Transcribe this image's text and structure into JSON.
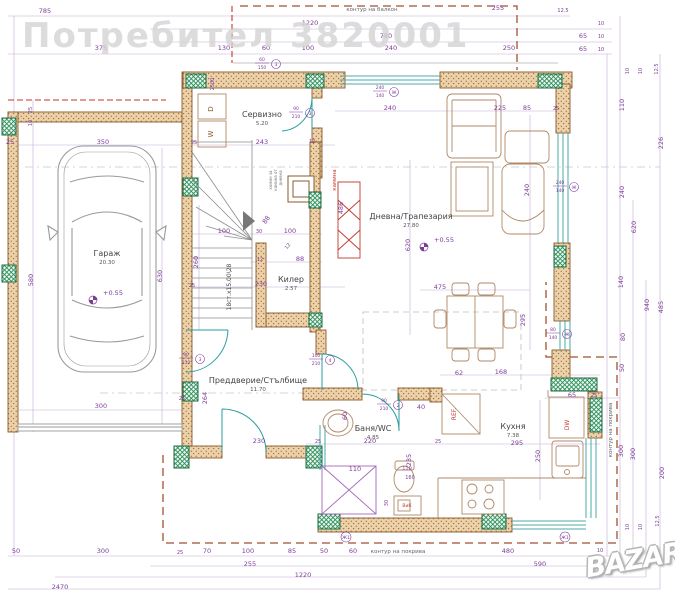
{
  "watermarks": {
    "top": "Потребител 3820001",
    "logo": "BAZAR"
  },
  "plan": {
    "colors": {
      "dimension": "#7d3c98",
      "wall": "#c98d52",
      "column": "#2f8f5b",
      "door": "#2a9d9d",
      "red": "#c0392b",
      "roof": "#a0522d",
      "furniture": "#b08968"
    },
    "rooms": [
      {
        "name": "Гараж",
        "area": "20.30",
        "x": 107,
        "y": 256
      },
      {
        "name": "Сервизно",
        "area": "5.20",
        "x": 262,
        "y": 117
      },
      {
        "name": "Дневна/Трапезария",
        "area": "27.80",
        "x": 411,
        "y": 219
      },
      {
        "name": "Килер",
        "area": "2.57",
        "x": 291,
        "y": 282
      },
      {
        "name": "Преддверие/Стълбище",
        "area": "11.70",
        "x": 258,
        "y": 383
      },
      {
        "name": "Баня/WC",
        "area": "4.85",
        "x": 373,
        "y": 431
      },
      {
        "name": "Кухня",
        "area": "7.38",
        "x": 513,
        "y": 429
      }
    ],
    "annotations": [
      {
        "t": "контур на балкон",
        "x": 372,
        "y": 11,
        "s": 5.5,
        "c": "#666"
      },
      {
        "t": "контур на покрива",
        "x": 398,
        "y": 553,
        "s": 5.5,
        "c": "#666"
      },
      {
        "t": "контур на покрива",
        "x": 612,
        "y": 430,
        "s": 5.5,
        "c": "#666",
        "r": -90
      },
      {
        "t": "D",
        "x": 213,
        "y": 109,
        "s": 7,
        "c": "#8a5a2b",
        "r": -90
      },
      {
        "t": "W",
        "x": 213,
        "y": 134,
        "s": 7,
        "c": "#8a5a2b",
        "r": -90
      },
      {
        "t": "REF.",
        "x": 456,
        "y": 414,
        "s": 6,
        "c": "#c0392b",
        "r": -90
      },
      {
        "t": "DW",
        "x": 569,
        "y": 425,
        "s": 6,
        "c": "#c0392b",
        "r": -90
      },
      {
        "t": "ВиК",
        "x": 407,
        "y": 507,
        "s": 4.5,
        "c": "#c0392b"
      },
      {
        "t": "камина",
        "x": 336,
        "y": 180,
        "s": 5.5,
        "c": "#c0392b",
        "r": -90
      },
      {
        "t": "комин за",
        "x": 272,
        "y": 180,
        "s": 4,
        "c": "#777",
        "r": -90
      },
      {
        "t": "камина от",
        "x": 277,
        "y": 180,
        "s": 4,
        "c": "#777",
        "r": -90
      },
      {
        "t": "дневна",
        "x": 282,
        "y": 178,
        "s": 4,
        "c": "#777",
        "r": -90
      },
      {
        "t": "18ст.х15.00\\28",
        "x": 231,
        "y": 287,
        "s": 6,
        "c": "#444",
        "r": -90
      }
    ],
    "levels": [
      {
        "label": "+0.55",
        "x": 93,
        "y": 300
      },
      {
        "label": "+0.55",
        "x": 424,
        "y": 247
      }
    ],
    "tags": [
      {
        "w": "90",
        "h": "210",
        "n": "3",
        "x": 296,
        "y": 112
      },
      {
        "w": "60",
        "h": "150",
        "n": "3",
        "x": 262,
        "y": 63
      },
      {
        "w": "240",
        "h": "140",
        "n": "Ж",
        "x": 380,
        "y": 91
      },
      {
        "w": "240",
        "h": "140",
        "n": "Ж",
        "x": 560,
        "y": 186
      },
      {
        "w": "80",
        "h": "140",
        "n": "Ж",
        "x": 553,
        "y": 333
      },
      {
        "w": "90",
        "h": "210",
        "n": "3",
        "x": 186,
        "y": 358
      },
      {
        "w": "100",
        "h": "210",
        "n": "4",
        "x": 316,
        "y": 359
      },
      {
        "w": "90",
        "h": "210",
        "n": "2",
        "x": 384,
        "y": 404
      },
      {
        "w": "",
        "h": "",
        "n": "Ж1",
        "x": 346,
        "y": 537
      },
      {
        "w": "",
        "h": "",
        "n": "Ж1",
        "x": 565,
        "y": 537
      }
    ],
    "dimensions": [
      {
        "t": "785",
        "x": 45,
        "y": 13
      },
      {
        "t": "255",
        "x": 498,
        "y": 10
      },
      {
        "t": "12.5",
        "x": 563,
        "y": 12,
        "s": 5
      },
      {
        "t": "1220",
        "x": 310,
        "y": 25
      },
      {
        "t": "780",
        "x": 386,
        "y": 38
      },
      {
        "t": "375",
        "x": 101,
        "y": 50
      },
      {
        "t": "130",
        "x": 224,
        "y": 50
      },
      {
        "t": "60",
        "x": 266,
        "y": 50
      },
      {
        "t": "100",
        "x": 308,
        "y": 50
      },
      {
        "t": "240",
        "x": 391,
        "y": 50
      },
      {
        "t": "250",
        "x": 509,
        "y": 50
      },
      {
        "t": "65",
        "x": 583,
        "y": 38
      },
      {
        "t": "10",
        "x": 601,
        "y": 25,
        "s": 5
      },
      {
        "t": "65",
        "x": 583,
        "y": 51
      },
      {
        "t": "10",
        "x": 601,
        "y": 38,
        "s": 5
      },
      {
        "t": "10",
        "x": 601,
        "y": 51,
        "s": 5
      },
      {
        "t": "10",
        "x": 629,
        "y": 71,
        "r": -90,
        "s": 5
      },
      {
        "t": "10",
        "x": 642,
        "y": 71,
        "r": -90,
        "s": 5
      },
      {
        "t": "12.5",
        "x": 658,
        "y": 69,
        "r": -90,
        "s": 5
      },
      {
        "t": "110",
        "x": 624,
        "y": 105,
        "r": -90
      },
      {
        "t": "226",
        "x": 663,
        "y": 143,
        "r": -90
      },
      {
        "t": "240",
        "x": 624,
        "y": 192,
        "r": -90
      },
      {
        "t": "620",
        "x": 636,
        "y": 227,
        "r": -90
      },
      {
        "t": "140",
        "x": 623,
        "y": 282,
        "r": -90
      },
      {
        "t": "940",
        "x": 649,
        "y": 305,
        "r": -90
      },
      {
        "t": "485",
        "x": 663,
        "y": 307,
        "r": -90
      },
      {
        "t": "80",
        "x": 625,
        "y": 337,
        "r": -90
      },
      {
        "t": "50",
        "x": 624,
        "y": 368,
        "r": -90
      },
      {
        "t": "300",
        "x": 623,
        "y": 451,
        "r": -90
      },
      {
        "t": "300",
        "x": 635,
        "y": 454,
        "r": -90
      },
      {
        "t": "200",
        "x": 664,
        "y": 473,
        "r": -90
      },
      {
        "t": "10",
        "x": 629,
        "y": 527,
        "r": -90,
        "s": 5
      },
      {
        "t": "10",
        "x": 642,
        "y": 527,
        "r": -90,
        "s": 5
      },
      {
        "t": "12.5",
        "x": 659,
        "y": 521,
        "r": -90,
        "s": 5
      },
      {
        "t": "25",
        "x": 10,
        "y": 144
      },
      {
        "t": "25",
        "x": 32,
        "y": 110,
        "r": -90,
        "s": 5
      },
      {
        "t": "10",
        "x": 32,
        "y": 123,
        "r": -90,
        "s": 5
      },
      {
        "t": "580",
        "x": 33,
        "y": 280,
        "r": -90
      },
      {
        "t": "630",
        "x": 162,
        "y": 276,
        "r": -90
      },
      {
        "t": "350",
        "x": 103,
        "y": 144
      },
      {
        "t": "25",
        "x": 194,
        "y": 144,
        "s": 5
      },
      {
        "t": "243",
        "x": 262,
        "y": 144
      },
      {
        "t": "12",
        "x": 312,
        "y": 143,
        "s": 5
      },
      {
        "t": "2500",
        "x": 214,
        "y": 84,
        "r": -90,
        "s": 5
      },
      {
        "t": "300",
        "x": 101,
        "y": 408
      },
      {
        "t": "100",
        "x": 224,
        "y": 233
      },
      {
        "t": "30",
        "x": 259,
        "y": 233,
        "s": 5
      },
      {
        "t": "100",
        "x": 290,
        "y": 233
      },
      {
        "t": "88",
        "x": 268,
        "y": 221,
        "r": -55
      },
      {
        "t": "12",
        "x": 289,
        "y": 247,
        "r": -55,
        "s": 5
      },
      {
        "t": "12",
        "x": 260,
        "y": 261,
        "s": 5
      },
      {
        "t": "88",
        "x": 300,
        "y": 261
      },
      {
        "t": "260",
        "x": 198,
        "y": 262,
        "r": -90
      },
      {
        "t": "230",
        "x": 261,
        "y": 286
      },
      {
        "t": "25",
        "x": 192,
        "y": 287,
        "s": 5
      },
      {
        "t": "486",
        "x": 343,
        "y": 208,
        "r": -90
      },
      {
        "t": "240",
        "x": 390,
        "y": 110
      },
      {
        "t": "225",
        "x": 500,
        "y": 110
      },
      {
        "t": "85",
        "x": 527,
        "y": 110
      },
      {
        "t": "25",
        "x": 556,
        "y": 110,
        "s": 5
      },
      {
        "t": "620",
        "x": 410,
        "y": 245,
        "r": -90
      },
      {
        "t": "240",
        "x": 529,
        "y": 190,
        "r": -90
      },
      {
        "t": "475",
        "x": 440,
        "y": 289
      },
      {
        "t": "295",
        "x": 525,
        "y": 320,
        "r": -90
      },
      {
        "t": "264",
        "x": 207,
        "y": 398,
        "r": -90
      },
      {
        "t": "230",
        "x": 259,
        "y": 443
      },
      {
        "t": "25",
        "x": 182,
        "y": 400,
        "s": 5
      },
      {
        "t": "60",
        "x": 347,
        "y": 416,
        "r": -90
      },
      {
        "t": "110",
        "x": 355,
        "y": 471
      },
      {
        "t": "220",
        "x": 370,
        "y": 443
      },
      {
        "t": "25",
        "x": 318,
        "y": 443,
        "s": 5
      },
      {
        "t": "25",
        "x": 438,
        "y": 443,
        "s": 5
      },
      {
        "t": "40",
        "x": 421,
        "y": 409
      },
      {
        "t": "235",
        "x": 411,
        "y": 460,
        "r": -90
      },
      {
        "t": "30",
        "x": 388,
        "y": 503,
        "r": -90,
        "s": 5
      },
      {
        "t": "110",
        "x": 407,
        "y": 470,
        "s": 5
      },
      {
        "t": "160",
        "x": 410,
        "y": 479,
        "s": 5
      },
      {
        "t": "62",
        "x": 459,
        "y": 375
      },
      {
        "t": "168",
        "x": 501,
        "y": 374
      },
      {
        "t": "65",
        "x": 572,
        "y": 397
      },
      {
        "t": "25",
        "x": 594,
        "y": 397,
        "s": 5
      },
      {
        "t": "295",
        "x": 517,
        "y": 445
      },
      {
        "t": "250",
        "x": 540,
        "y": 456,
        "r": -90
      },
      {
        "t": "50",
        "x": 16,
        "y": 553
      },
      {
        "t": "300",
        "x": 103,
        "y": 553
      },
      {
        "t": "25",
        "x": 180,
        "y": 554,
        "s": 5
      },
      {
        "t": "70",
        "x": 207,
        "y": 553
      },
      {
        "t": "100",
        "x": 248,
        "y": 553
      },
      {
        "t": "85",
        "x": 292,
        "y": 553
      },
      {
        "t": "50",
        "x": 324,
        "y": 553
      },
      {
        "t": "60",
        "x": 353,
        "y": 553
      },
      {
        "t": "480",
        "x": 508,
        "y": 553
      },
      {
        "t": "10",
        "x": 600,
        "y": 552,
        "s": 5
      },
      {
        "t": "255",
        "x": 250,
        "y": 566
      },
      {
        "t": "590",
        "x": 540,
        "y": 566
      },
      {
        "t": "1220",
        "x": 303,
        "y": 577
      },
      {
        "t": "2470",
        "x": 60,
        "y": 589
      }
    ]
  }
}
